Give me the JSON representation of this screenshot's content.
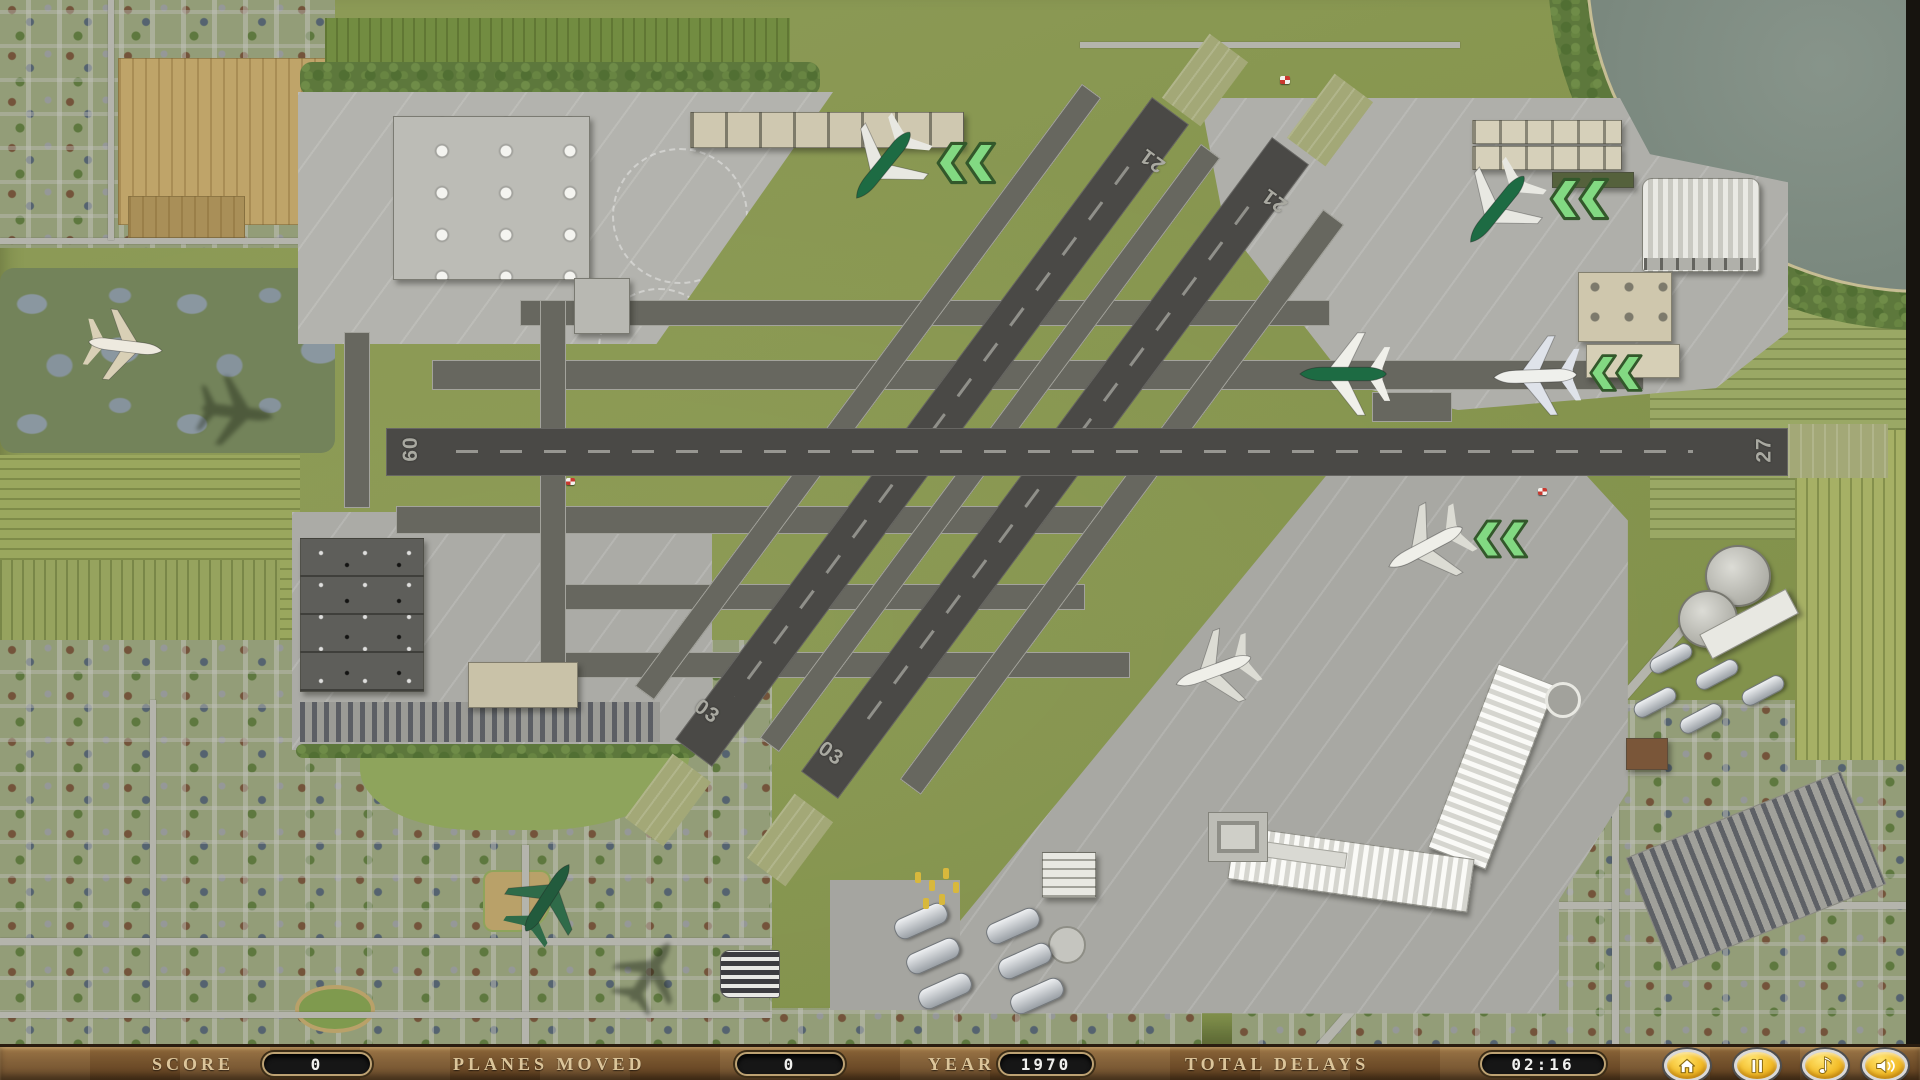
{
  "hud": {
    "score_label": "SCORE",
    "score_value": "0",
    "planes_moved_label": "PLANES MOVED",
    "planes_moved_value": "0",
    "year_label": "YEAR",
    "year_value": "1970",
    "total_delays_label": "TOTAL DELAYS",
    "total_delays_value": "02:16",
    "buttons": [
      {
        "name": "home-button",
        "icon": "house-icon"
      },
      {
        "name": "pause-button",
        "icon": "pause-icon"
      },
      {
        "name": "music-button",
        "icon": "music-note-icon"
      },
      {
        "name": "sound-button",
        "icon": "speaker-icon"
      }
    ]
  },
  "runways": {
    "horizontal": {
      "left": "09",
      "right": "27"
    },
    "diagonal_left": {
      "top": "21",
      "bottom": "03"
    },
    "diagonal_right": {
      "top": "21",
      "bottom": "03"
    }
  },
  "planes": [
    {
      "name": "airliner-flying-over-marsh",
      "livery": "white"
    },
    {
      "name": "airliner-north-terminal-gate",
      "livery": "green"
    },
    {
      "name": "airliner-northeast-apron-gate",
      "livery": "green"
    },
    {
      "name": "airliner-taxiing-center",
      "livery": "green"
    },
    {
      "name": "airliner-east-taxiway",
      "livery": "white-blue"
    },
    {
      "name": "airliner-southeast-taxiway",
      "livery": "white"
    },
    {
      "name": "airliner-south-apron",
      "livery": "white"
    },
    {
      "name": "airliner-departing-over-town",
      "livery": "green"
    }
  ],
  "colors": {
    "chevron_green": "#82d982",
    "plane_green": "#1d6b43",
    "button_gold": "#f2c12e",
    "hud_wood": "#7d5c35",
    "display_bg": "#161616",
    "runway_gray": "#4a4946",
    "apron_gray": "#afafaa",
    "water": "#7e8c82"
  }
}
